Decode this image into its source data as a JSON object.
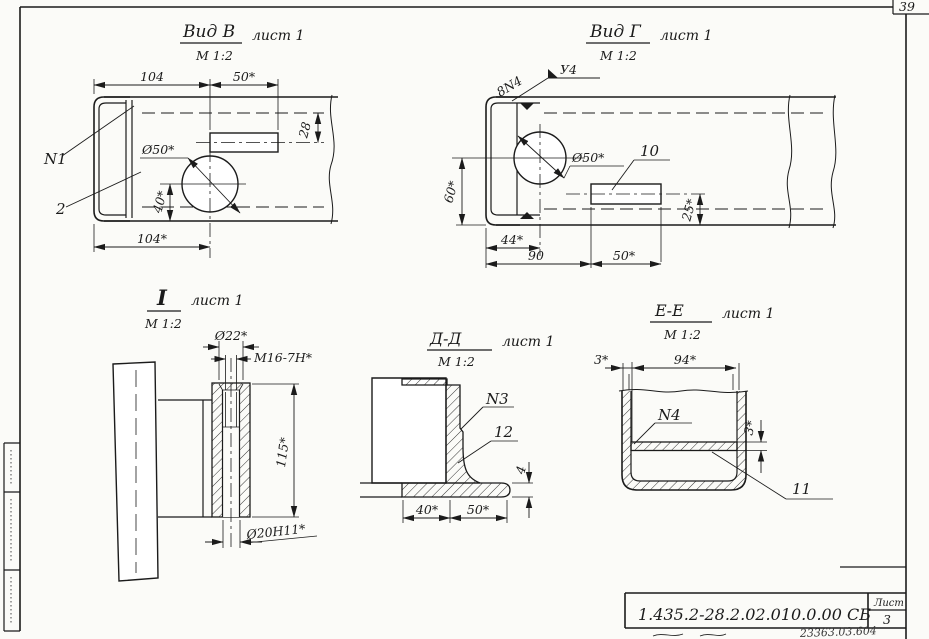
{
  "sheet": {
    "page_stamp": "39",
    "title_block": {
      "doc_number": "1.435.2-28.2.02.010.0.00 СБ",
      "sheet_label": "Лист",
      "sheet_number": "3",
      "handwritten_note": "23363.03.604"
    }
  },
  "view_b": {
    "title": "Вид В",
    "sheet_ref": "лист 1",
    "scale": "М 1:2",
    "dim_top_left": "104",
    "dim_top_right": "50*",
    "dim_offset": "28",
    "dim_dia_hole": "Ø50*",
    "dim_40": "40*",
    "dim_bottom": "104*",
    "label_n1": "N1",
    "label_2": "2"
  },
  "view_g": {
    "title": "Вид Г",
    "sheet_ref": "лист 1",
    "scale": "М 1:2",
    "weld_size": "8N4",
    "weld_flag": "У4",
    "dim_dia_hole": "Ø50*",
    "dim_60": "60*",
    "dim_44": "44*",
    "dim_90": "90",
    "dim_50": "50*",
    "dim_25": "25*",
    "label_10": "10"
  },
  "view_i": {
    "title": "I",
    "sheet_ref": "лист 1",
    "scale": "М 1:2",
    "dim_dia22": "Ø22*",
    "dim_thread": "М16-7Н*",
    "dim_115": "115*",
    "dim_dia20": "Ø20Н11*"
  },
  "view_dd": {
    "title": "Д-Д",
    "sheet_ref": "лист 1",
    "scale": "М 1:2",
    "dim_40": "40*",
    "dim_50": "50*",
    "dim_4": "4",
    "label_n3": "N3",
    "label_12": "12"
  },
  "view_ee": {
    "title": "Е-Е",
    "sheet_ref": "лист 1",
    "scale": "М 1:2",
    "dim_3_left": "3*",
    "dim_94": "94*",
    "dim_3_right": "3*",
    "label_n4": "N4",
    "label_11": "11"
  }
}
